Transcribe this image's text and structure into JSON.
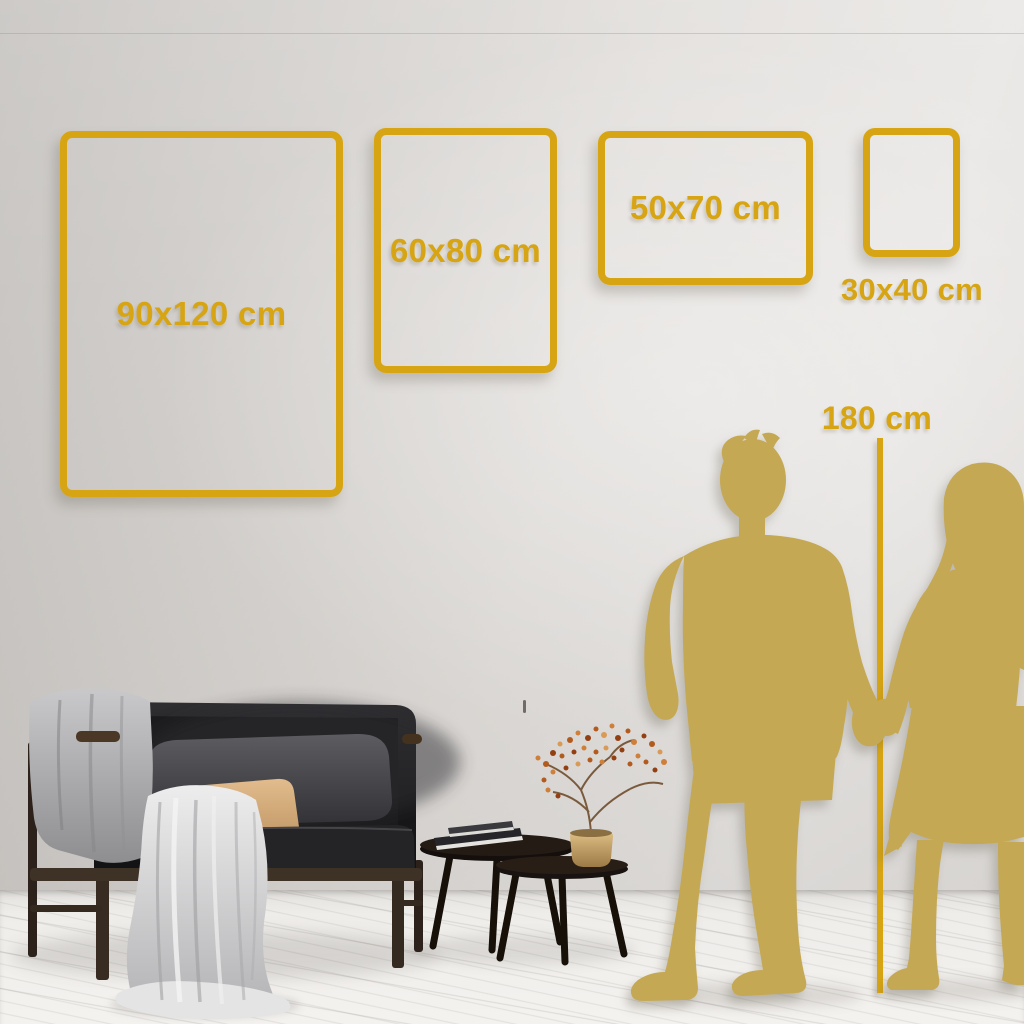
{
  "frames": [
    {
      "label": "90x120 cm",
      "width_cm": 90,
      "height_cm": 120
    },
    {
      "label": "60x80 cm",
      "width_cm": 60,
      "height_cm": 80
    },
    {
      "label": "50x70 cm",
      "width_cm": 50,
      "height_cm": 70
    },
    {
      "label": "30x40 cm",
      "width_cm": 30,
      "height_cm": 40
    }
  ],
  "height_marker": {
    "label": "180 cm",
    "height_cm": 180
  },
  "colors": {
    "accent_gold": "#D7A513",
    "silhouette_gold": "#C5A854",
    "wall_gray": "#DEDBD8",
    "floor_white": "#F0EFED"
  },
  "decor": {
    "figures": [
      "man-silhouette",
      "woman-silhouette"
    ],
    "furniture": [
      "sofa",
      "throw-blanket",
      "nesting-coffee-tables",
      "dried-branch-vase"
    ]
  }
}
